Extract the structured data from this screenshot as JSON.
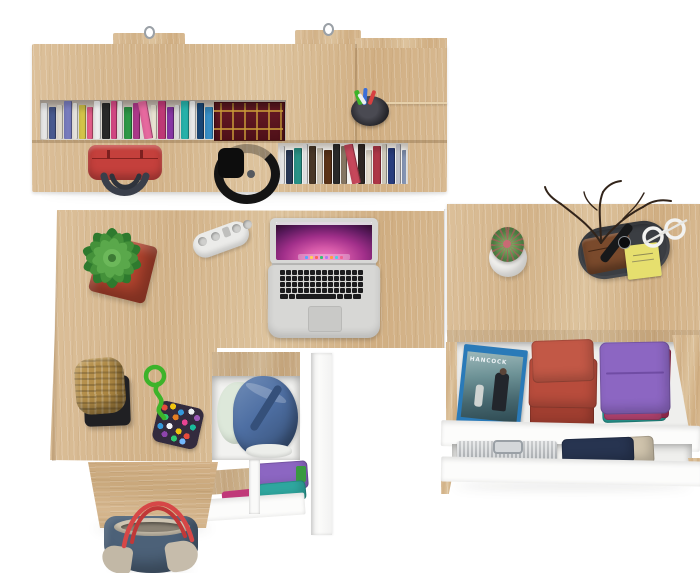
{
  "scene": {
    "description": "Top-down render of a light-oak home office set: wall shelf with books, desk with open laptop, and chests with open drawers of folded clothes",
    "background": "#ffffff"
  },
  "materials": {
    "oak": "#d6b890",
    "oak_dark": "#c9a87c",
    "white_panel": "#fcfcfb"
  },
  "shelf": {
    "label": "wall-mounted shelf with two book rows",
    "hooks": 2,
    "pen_cup": {
      "label": "pen cup with pens",
      "cup_color": "#26262b"
    },
    "handbag": {
      "label": "red handbag",
      "color": "#c4403c",
      "handle_color": "#3a3f4a"
    },
    "headphones": {
      "label": "black folded headphones",
      "color": "#141414"
    },
    "feature_book": {
      "label": "antique red-and-gold book block",
      "color": "#5a1620",
      "accent": "#c99b38"
    },
    "row1_books": [
      {
        "c": "#ebebeb",
        "w": 7
      },
      {
        "c": "#4a5c92",
        "w": 7
      },
      {
        "c": "#e8e2d4",
        "w": 6
      },
      {
        "c": "#7a7ec0",
        "w": 8
      },
      {
        "c": "#f0eee8",
        "w": 5
      },
      {
        "c": "#d8c84a",
        "w": 7
      },
      {
        "c": "#e8608c",
        "w": 6
      },
      {
        "c": "#f2f2f2",
        "w": 7
      },
      {
        "c": "#2a2a2a",
        "w": 8
      },
      {
        "c": "#d84a86",
        "w": 6
      },
      {
        "c": "#ececec",
        "w": 5
      },
      {
        "c": "#2f9a48",
        "w": 8
      },
      {
        "c": "#b03a8c",
        "w": 7
      },
      {
        "c": "#e86aa0",
        "w": 9,
        "t": -10
      },
      {
        "c": "#f0ead8",
        "w": 6
      },
      {
        "c": "#c23a78",
        "w": 8
      },
      {
        "c": "#8a38a8",
        "w": 7
      },
      {
        "c": "#e8e8e8",
        "w": 5
      },
      {
        "c": "#28b4ac",
        "w": 8
      },
      {
        "c": "#f0f0f0",
        "w": 6
      },
      {
        "c": "#1a4878",
        "w": 7
      },
      {
        "c": "#3890c8",
        "w": 8
      },
      {
        "c": "#e8e8e8",
        "w": 5
      },
      {
        "c": "#28a8a0",
        "w": 6
      },
      {
        "c": "#303030",
        "w": 6
      },
      {
        "c": "#dcdcdc",
        "w": 5
      }
    ],
    "row2_books": [
      {
        "c": "#f0f0f0",
        "w": 5
      },
      {
        "c": "#2a3a58",
        "w": 7
      },
      {
        "c": "#2a9488",
        "w": 8
      },
      {
        "c": "#ececec",
        "w": 5
      },
      {
        "c": "#4a3828",
        "w": 7
      },
      {
        "c": "#d0c8b8",
        "w": 6
      },
      {
        "c": "#5c3418",
        "w": 8
      },
      {
        "c": "#2a2a2a",
        "w": 7
      },
      {
        "c": "#8a7a66",
        "w": 6
      },
      {
        "c": "#c8485c",
        "w": 9,
        "t": -12
      },
      {
        "c": "#302824",
        "w": 7
      },
      {
        "c": "#ece4d4",
        "w": 6
      },
      {
        "c": "#b03848",
        "w": 8
      },
      {
        "c": "#d8d2c4",
        "w": 5
      },
      {
        "c": "#2a3e80",
        "w": 7
      },
      {
        "c": "#ccccd4",
        "w": 5
      },
      {
        "c": "#8898b8",
        "w": 7
      },
      {
        "c": "#d4a01c",
        "w": 7,
        "t": 10
      },
      {
        "c": "#242424",
        "w": 6
      },
      {
        "c": "#4a6aaa",
        "w": 7
      }
    ]
  },
  "desk": {
    "label": "desk with laptop",
    "plant": {
      "label": "potted succulent",
      "pot_color": "#b5452f",
      "leaf_colors": [
        "#2e7a2e",
        "#44913a",
        "#5aa84b",
        "#6cb85a"
      ]
    },
    "power_strip": {
      "label": "white power strip",
      "color": "#ebebe9",
      "sockets": 4
    },
    "laptop": {
      "label": "open silver laptop",
      "body_color": "#d7d7d5",
      "wallpaper": [
        "#f07cc4",
        "#c04898",
        "#38104a"
      ],
      "dock_icon_colors": [
        "#58a6ff",
        "#ffd454",
        "#ff6259",
        "#38c172",
        "#b07cf0",
        "#ff9f40",
        "#4dd0e1",
        "#f06292"
      ]
    }
  },
  "right_unit": {
    "label": "chest of drawers with two open drawers",
    "cactus": {
      "label": "cactus in round white pot",
      "pot_color": "#f2f1ee",
      "body_color": "#4e7c42",
      "spine_color": "#b85560"
    },
    "valet_tray": {
      "label": "dark valet tray",
      "color": "#3b3e43"
    },
    "wallet": {
      "label": "brown leather wallet",
      "color": "#7a4a2c"
    },
    "sticky_notes": {
      "label": "yellow sticky notes",
      "color": "#e6df6e"
    },
    "watch": {
      "label": "black wristwatch",
      "color": "#17181a"
    },
    "glasses": {
      "label": "white eyeglasses",
      "color": "#f2f2f0"
    },
    "twigs": {
      "label": "decorative dry twigs",
      "color": "#32241a"
    },
    "drawer1": {
      "bluray": {
        "title": "HANCOCK",
        "label": "blu-ray movie case",
        "case_color": "#2a7ab8"
      },
      "red_stack": {
        "label": "folded rust-red clothes",
        "color": "#b84c3c"
      },
      "shirt_stack": {
        "label": "folded shirt stack",
        "colors": [
          "#8c66c2",
          "#2ba49c",
          "#a83058",
          "#d4bc2c",
          "#c04878"
        ]
      }
    },
    "drawer2": {
      "metal_case": {
        "label": "aluminium case",
        "color": "#c3c7cb"
      },
      "navy_clothes": {
        "label": "folded navy clothes",
        "colors": [
          "#273450",
          "#cfc3ac"
        ]
      }
    }
  },
  "pedestal": {
    "label": "desk pedestal with open drawers",
    "basket": {
      "label": "woven basket on black stand",
      "basket_color": "#b5914f",
      "stand_color": "#202023"
    },
    "toy": {
      "label": "beaded pouch with green rope",
      "rope_color": "#3db32a"
    },
    "drawer_top": {
      "label": "open drawer with denim bag",
      "denim_color": "#4e6fa3",
      "cloth_color": "#dde8da"
    },
    "drawer_bottom": {
      "label": "lower drawer with folded shirts",
      "colors": [
        "#8c66c2",
        "#2fa8a0",
        "#c03878"
      ]
    }
  },
  "tote": {
    "label": "canvas tote bag",
    "body_color": "#4c6178",
    "trim_color": "#cfc5b2",
    "handle_color": "#d64747"
  }
}
